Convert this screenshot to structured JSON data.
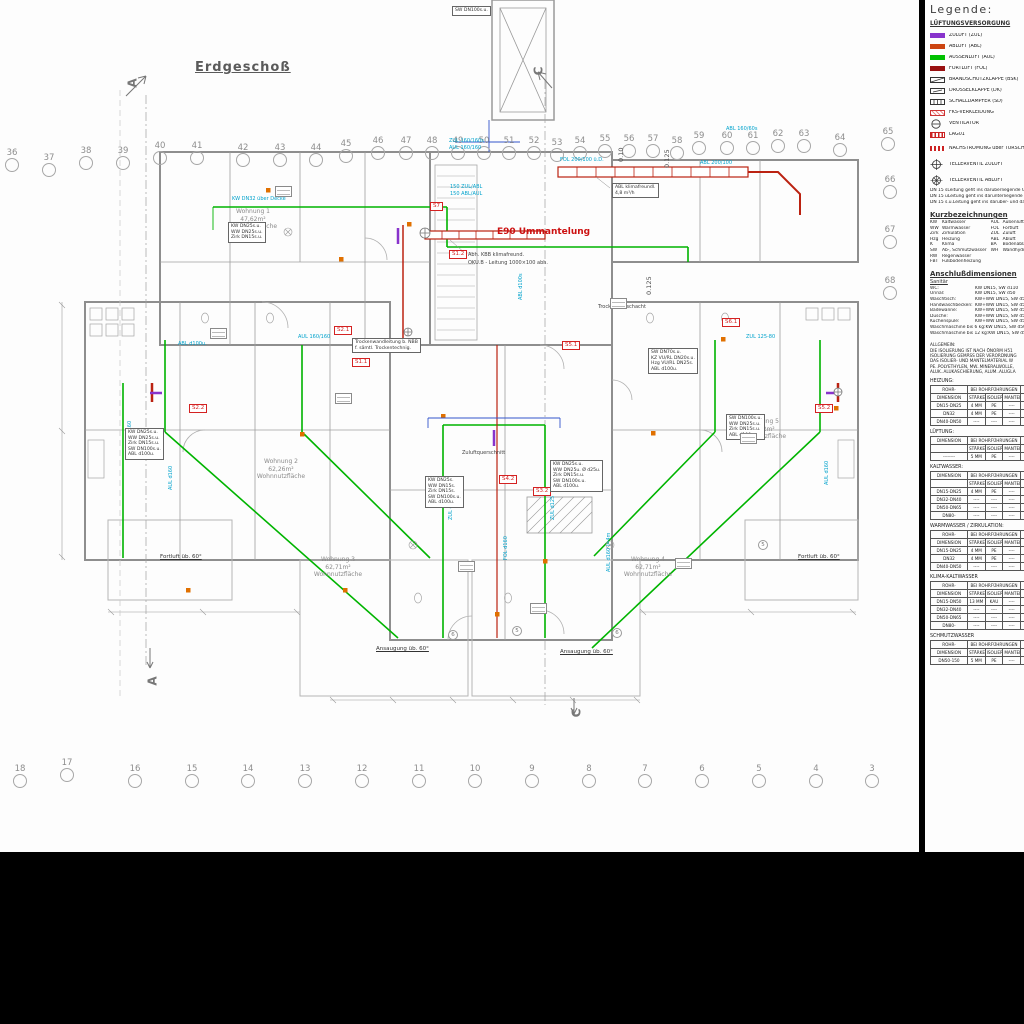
{
  "sheet": {
    "title": "Erdgeschoß"
  },
  "legend": {
    "heading": "Legende:",
    "vent_title": "LÜFTUNGSVERSORGUNG",
    "vent_items": [
      {
        "label": "ZULUFT  (ZUL)",
        "icon": "swatch",
        "color": "#8833cc"
      },
      {
        "label": "ABLUFT  (ABL)",
        "icon": "swatch",
        "color": "#cc4411"
      },
      {
        "label": "AUSSENLUFT  (AUL)",
        "icon": "swatch",
        "color": "#00c000"
      },
      {
        "label": "FORTLUFT  (FOL)",
        "icon": "swatch",
        "color": "#991111"
      },
      {
        "label": "BRANDSCHUTZKLAPPE  (BSK)",
        "icon": "bsk"
      },
      {
        "label": "DROSSELKLAPPE  (DK)",
        "icon": "dk"
      },
      {
        "label": "SCHALLDÄMPFER  (SD)",
        "icon": "sd"
      },
      {
        "label": "FKS-VERKLEIDUNG",
        "icon": "fks"
      },
      {
        "label": "VENTILATOR",
        "icon": "fan"
      },
      {
        "label": "LAG01",
        "icon": "lag"
      }
    ],
    "valve_items": [
      {
        "label": "NACHSTRÖMUNG über TÜRSCHLITZ",
        "icon": "doorflow"
      },
      {
        "label": "TELLERVENTIL ZULUFT",
        "icon": "valvez"
      },
      {
        "label": "TELLERVENTIL ABLUFT",
        "icon": "valvea"
      }
    ],
    "dn_notes": [
      [
        "DN 15 s",
        "Leitung geht ins darüberliegende Geschoß"
      ],
      [
        "DN 15 u",
        "Leitung geht ins darunterliegende Geschoß"
      ],
      [
        "DN 15 s.u.",
        "Leitung geht ins darüber- und darunterliegende Geschoß"
      ]
    ],
    "abbrev_title": "Kurzbezeichnungen",
    "abbrev_left": [
      [
        "KW",
        "Kaltwasser"
      ],
      [
        "WW",
        "Warmwasser"
      ],
      [
        "Zirk",
        "Zirkulation"
      ],
      [
        "Hzg",
        "Heizung"
      ],
      [
        "K",
        "Klima"
      ],
      [
        "SW",
        "Ab-, Schmutzwasser"
      ],
      [
        "RW",
        "Regenwasser"
      ],
      [
        "FBT",
        "Fußbodenheizung"
      ]
    ],
    "abbrev_right": [
      [
        "AUL",
        "Außenluft"
      ],
      [
        "FOL",
        "Fortluft"
      ],
      [
        "ZUL",
        "Zuluft"
      ],
      [
        "ABL",
        "Abluft"
      ],
      [
        "BA",
        "Bodenablauf"
      ],
      [
        "WH",
        "Wandhydrant"
      ]
    ],
    "anschluss_title": "Anschlußdimensionen",
    "anschluss_sub": "Sanitär",
    "anschluss_rows": [
      [
        "WC:",
        "KW DN15, SW d110"
      ],
      [
        "Urinal:",
        "KW DN15, SW d50"
      ],
      [
        "Waschtisch:",
        "KW+WW DN15, SW d50"
      ],
      [
        "Handwaschbecken:",
        "KW+WW DN15, SW d50"
      ],
      [
        "Badewanne:",
        "KW+WW DN15, SW d50"
      ],
      [
        "Dusche:",
        "KW+WW DN15, SW d50"
      ],
      [
        "Küchenspüle:",
        "KW+WW DN15, SW d50"
      ],
      [
        "Waschmaschine bis 6 kg:",
        "KW DN15, SW d50"
      ],
      [
        "Waschmaschine bis 12 kg:",
        "KW DN15, SW d50"
      ]
    ],
    "allgemein": [
      "ALLGEMEIN:",
      "DIE ISOLIERUNG IST NACH ÖNORM H51",
      "ISOLIERUNG GEMÄSS DER VERORDNUNG",
      "DAS ISOLIER- UND MANTELMATERIAL W",
      "PE..POLYETHYLEN, MW..MINERALWOLLE,",
      "ALUK..ALUKASCHIERUNG, ALUM..ALUGLA"
    ],
    "tables": [
      {
        "title": "HEIZUNG:",
        "dim": [
          "ROHR-",
          "DIMENSION"
        ],
        "group": "BEI ROHRFÜHRUNGEN",
        "subs": [
          "STÄRKE",
          "ISOLIER.",
          "MANTEL"
        ],
        "rows": [
          [
            "DN15-DN25",
            "4 MM",
            "PE",
            "----"
          ],
          [
            "DN32",
            "4 MM",
            "PE",
            "----"
          ],
          [
            "DN40-DN50",
            "----",
            "----",
            "----"
          ]
        ]
      },
      {
        "title": "LÜFTUNG:",
        "dim": [
          "DIMENSION",
          ""
        ],
        "group": "BEI ROHRFÜHRUNGEN",
        "subs": [
          "STÄRKE",
          "ISOLIER.",
          "MANTEL"
        ],
        "rows": [
          [
            "--------",
            "5 MM",
            "PE",
            "----"
          ]
        ]
      },
      {
        "title": "KALTWASSER:",
        "dim": [
          "DIMENSION",
          ""
        ],
        "group": "BEI ROHRFÜHRUNGEN",
        "subs": [
          "STÄRKE",
          "ISOLIER.",
          "MANTEL"
        ],
        "rows": [
          [
            "DN15-DN25",
            "4 MM",
            "PE",
            "----"
          ],
          [
            "DN32-DN40",
            "----",
            "----",
            "----"
          ],
          [
            "DN50-DN65",
            "----",
            "----",
            "----"
          ],
          [
            "DN80-",
            "----",
            "----",
            "----"
          ]
        ]
      },
      {
        "title": "WARMWASSER / ZIRKULATION:",
        "dim": [
          "ROHR-",
          "DIMENSION"
        ],
        "group": "BEI ROHRFÜHRUNGEN",
        "subs": [
          "STÄRKE",
          "ISOLIER.",
          "MANTEL"
        ],
        "rows": [
          [
            "DN15-DN25",
            "4 MM",
            "PE",
            "----"
          ],
          [
            "DN32",
            "4 MM",
            "PE",
            "----"
          ],
          [
            "DN40-DN50",
            "----",
            "----",
            "----"
          ]
        ]
      },
      {
        "title": "KLIMA-KALTWASSER",
        "dim": [
          "ROHR-",
          "DIMENSION"
        ],
        "group": "BEI ROHRFÜHRUNGEN",
        "subs": [
          "STÄRKE",
          "ISOLIER.",
          "MANTEL"
        ],
        "rows": [
          [
            "DN15-DN50",
            "13 MM",
            "KAU",
            "----"
          ],
          [
            "DN32-DN40",
            "----",
            "----",
            "----"
          ],
          [
            "DN50-DN65",
            "----",
            "----",
            "----"
          ],
          [
            "DN80-",
            "----",
            "----",
            "----"
          ]
        ]
      },
      {
        "title": "SCHMUTZWASSER",
        "dim": [
          "ROHR-",
          "DIMENSION"
        ],
        "group": "BEI ROHRFÜHRUNGEN",
        "subs": [
          "STÄRKE",
          "ISOLIER.",
          "MANTEL"
        ],
        "rows": [
          [
            "DN50-150",
            "5 MM",
            "PE",
            "----"
          ]
        ]
      }
    ]
  },
  "grid": {
    "top": [
      {
        "n": "36",
        "x": 12,
        "y": 165
      },
      {
        "n": "37",
        "x": 49,
        "y": 170
      },
      {
        "n": "38",
        "x": 86,
        "y": 163
      },
      {
        "n": "39",
        "x": 123,
        "y": 163
      },
      {
        "n": "40",
        "x": 160,
        "y": 158
      },
      {
        "n": "41",
        "x": 197,
        "y": 158
      },
      {
        "n": "42",
        "x": 243,
        "y": 160
      },
      {
        "n": "43",
        "x": 280,
        "y": 160
      },
      {
        "n": "44",
        "x": 316,
        "y": 160
      },
      {
        "n": "45",
        "x": 346,
        "y": 156
      },
      {
        "n": "46",
        "x": 378,
        "y": 153
      },
      {
        "n": "47",
        "x": 406,
        "y": 153
      },
      {
        "n": "48",
        "x": 432,
        "y": 153
      },
      {
        "n": "49",
        "x": 458,
        "y": 153
      },
      {
        "n": "50",
        "x": 484,
        "y": 153
      },
      {
        "n": "51",
        "x": 509,
        "y": 153
      },
      {
        "n": "52",
        "x": 534,
        "y": 153
      },
      {
        "n": "53",
        "x": 557,
        "y": 155
      },
      {
        "n": "54",
        "x": 580,
        "y": 153
      },
      {
        "n": "55",
        "x": 605,
        "y": 151
      },
      {
        "n": "56",
        "x": 629,
        "y": 151
      },
      {
        "n": "57",
        "x": 653,
        "y": 151
      },
      {
        "n": "58",
        "x": 677,
        "y": 153
      },
      {
        "n": "59",
        "x": 699,
        "y": 148
      },
      {
        "n": "60",
        "x": 727,
        "y": 148
      },
      {
        "n": "61",
        "x": 753,
        "y": 148
      },
      {
        "n": "62",
        "x": 778,
        "y": 146
      },
      {
        "n": "63",
        "x": 804,
        "y": 146
      },
      {
        "n": "64",
        "x": 840,
        "y": 150
      },
      {
        "n": "65",
        "x": 888,
        "y": 144
      }
    ],
    "right": [
      {
        "n": "66",
        "x": 890,
        "y": 192
      },
      {
        "n": "67",
        "x": 890,
        "y": 242
      },
      {
        "n": "68",
        "x": 890,
        "y": 293
      }
    ],
    "bottom": [
      {
        "n": "18",
        "x": 20,
        "y": 781
      },
      {
        "n": "17",
        "x": 67,
        "y": 775
      },
      {
        "n": "16",
        "x": 135,
        "y": 781
      },
      {
        "n": "15",
        "x": 192,
        "y": 781
      },
      {
        "n": "14",
        "x": 248,
        "y": 781
      },
      {
        "n": "13",
        "x": 305,
        "y": 781
      },
      {
        "n": "12",
        "x": 362,
        "y": 781
      },
      {
        "n": "11",
        "x": 419,
        "y": 781
      },
      {
        "n": "10",
        "x": 475,
        "y": 781
      },
      {
        "n": "9",
        "x": 532,
        "y": 781
      },
      {
        "n": "8",
        "x": 589,
        "y": 781
      },
      {
        "n": "7",
        "x": 645,
        "y": 781
      },
      {
        "n": "6",
        "x": 702,
        "y": 781
      },
      {
        "n": "5",
        "x": 759,
        "y": 781
      },
      {
        "n": "4",
        "x": 816,
        "y": 781
      },
      {
        "n": "3",
        "x": 872,
        "y": 781
      }
    ]
  },
  "sections": [
    {
      "label": "A",
      "x": 128,
      "y": 76
    },
    {
      "label": "A",
      "x": 148,
      "y": 674
    },
    {
      "label": "C",
      "x": 534,
      "y": 64
    },
    {
      "label": "C",
      "x": 572,
      "y": 706
    }
  ],
  "plan": {
    "texts": [
      {
        "t": "ZUL 160/160s",
        "x": 449,
        "y": 138,
        "c": "cyan"
      },
      {
        "t": "AUL 160/160",
        "x": 449,
        "y": 145,
        "c": "cyan"
      },
      {
        "t": "150 ZUL/ABL",
        "x": 450,
        "y": 184,
        "c": "cyan"
      },
      {
        "t": "150 ABL/AUL",
        "x": 450,
        "y": 191,
        "c": "cyan"
      },
      {
        "t": "FOL 200/100 ü.D.",
        "x": 560,
        "y": 157,
        "c": "cyan"
      },
      {
        "t": "ABL 200/100",
        "x": 700,
        "y": 160,
        "c": "cyan"
      },
      {
        "t": "ABL 160/60s",
        "x": 726,
        "y": 126,
        "c": "cyan"
      },
      {
        "t": "KW DN32 über Decke",
        "x": 232,
        "y": 196,
        "c": "cyan"
      },
      {
        "t": "AUL 160/160",
        "x": 298,
        "y": 334,
        "c": "cyan"
      },
      {
        "t": "ZUL 125-80",
        "x": 746,
        "y": 334,
        "c": "cyan"
      },
      {
        "t": "ABL d100u.",
        "x": 178,
        "y": 341,
        "c": "cyan"
      },
      {
        "t": "ABL d100s",
        "x": 518,
        "y": 300,
        "c": "cyan r90"
      },
      {
        "t": "AUL d160",
        "x": 127,
        "y": 445,
        "c": "cyan r90"
      },
      {
        "t": "ZUL d125",
        "x": 448,
        "y": 520,
        "c": "cyan r90"
      },
      {
        "t": "ZUL d125",
        "x": 550,
        "y": 520,
        "c": "cyan r90"
      },
      {
        "t": "FOL d160",
        "x": 503,
        "y": 560,
        "c": "cyan r90"
      },
      {
        "t": "AUL d160 l=4m",
        "x": 606,
        "y": 572,
        "c": "cyan r90"
      },
      {
        "t": "AUL d160",
        "x": 824,
        "y": 485,
        "c": "cyan r90"
      },
      {
        "t": "AUL d160",
        "x": 168,
        "y": 490,
        "c": "cyan r90"
      },
      {
        "t": "Abh. KBB klimafreund.",
        "x": 468,
        "y": 252,
        "c": "blk"
      },
      {
        "t": "OKU.B - Leitung 1000×100 abh.",
        "x": 468,
        "y": 260,
        "c": "blk"
      },
      {
        "t": "Trockenbauschacht",
        "x": 598,
        "y": 304,
        "c": "blk"
      },
      {
        "t": "Zuluftquerschnitt",
        "x": 462,
        "y": 450,
        "c": "blk"
      },
      {
        "t": "Fortluft üb. 60°",
        "x": 160,
        "y": 554,
        "c": "undl"
      },
      {
        "t": "Fortluft üb. 60°",
        "x": 798,
        "y": 554,
        "c": "undl"
      },
      {
        "t": "Ansaugung üb. 60°",
        "x": 376,
        "y": 646,
        "c": "undl"
      },
      {
        "t": "Ansaugung üb. 60°",
        "x": 560,
        "y": 649,
        "c": "undl"
      },
      {
        "t": "0.10",
        "x": 618,
        "y": 162,
        "c": "dim r90"
      },
      {
        "t": "0.125",
        "x": 664,
        "y": 168,
        "c": "dim r90"
      },
      {
        "t": "0.125",
        "x": 646,
        "y": 295,
        "c": "dim r90"
      },
      {
        "t": "E90 Ummantelung",
        "x": 497,
        "y": 229,
        "c": "e90"
      }
    ],
    "apartments": [
      {
        "lines": [
          "Wohnung 1",
          "47,62m²",
          "Wohnnutzfläche"
        ],
        "x": 253,
        "y": 208
      },
      {
        "lines": [
          "Wohnung 2",
          "62,26m²",
          "Wohnnutzfläche"
        ],
        "x": 281,
        "y": 458
      },
      {
        "lines": [
          "Wohnung 3",
          "62,71m²",
          "Wohnnutzfläche"
        ],
        "x": 338,
        "y": 556
      },
      {
        "lines": [
          "Wohnung 4",
          "62,71m²",
          "Wohnnutzfläche"
        ],
        "x": 648,
        "y": 556
      },
      {
        "lines": [
          "Wohnung 5",
          "47,62m²",
          "Wohnnutzfläche"
        ],
        "x": 762,
        "y": 418
      }
    ],
    "stags": [
      {
        "t": "S7",
        "x": 430,
        "y": 202
      },
      {
        "t": "S1.2",
        "x": 449,
        "y": 250
      },
      {
        "t": "S2.1",
        "x": 334,
        "y": 326
      },
      {
        "t": "S1.1",
        "x": 352,
        "y": 358
      },
      {
        "t": "S2.2",
        "x": 189,
        "y": 404
      },
      {
        "t": "S4.2",
        "x": 499,
        "y": 475
      },
      {
        "t": "S3.2",
        "x": 533,
        "y": 487
      },
      {
        "t": "S5.1",
        "x": 562,
        "y": 341
      },
      {
        "t": "S5.2",
        "x": 815,
        "y": 404
      },
      {
        "t": "S6.1",
        "x": 722,
        "y": 318
      }
    ],
    "specboxes": [
      {
        "x": 452,
        "y": 6,
        "lines": [
          "SW DN100s.u."
        ]
      },
      {
        "x": 612,
        "y": 183,
        "lines": [
          "ABL klimafreundl.",
          "4,8 m³/h"
        ]
      },
      {
        "x": 228,
        "y": 222,
        "lines": [
          "KW DN25s.u.",
          "WW DN25s.u.",
          "Zirk DN15s.u."
        ]
      },
      {
        "x": 352,
        "y": 338,
        "lines": [
          "Trockenwandleitung b. NBB",
          "f. sämtl. Trockentechnig."
        ]
      },
      {
        "x": 648,
        "y": 348,
        "lines": [
          "SW DN70s.u.",
          "KZ VU/RL DN20s.u.",
          "Hzg VU/RL DN25s.",
          "ABL d100u."
        ]
      },
      {
        "x": 125,
        "y": 428,
        "lines": [
          "KW DN25s.u.",
          "WW DN25s.u.",
          "Zirk DN15s.u.",
          "SW DN100s.u.",
          "ABL d100u."
        ]
      },
      {
        "x": 550,
        "y": 460,
        "lines": [
          "KW DN25s.u.",
          "WW DN25u. Ø d25u.",
          "Zirk DN15s.u.",
          "SW DN100s.u.",
          "ABL d100u."
        ]
      },
      {
        "x": 425,
        "y": 476,
        "lines": [
          "KW DN25s.",
          "WW DN15s.",
          "Zirk DN15s.",
          "SW DN100s.u.",
          "ABL d100u."
        ]
      },
      {
        "x": 726,
        "y": 414,
        "lines": [
          "SW DN100s.u.",
          "WW DN25s.u.",
          "Zirk DN15s.u.",
          "ABL d100u."
        ]
      }
    ],
    "circnums": [
      {
        "t": "6",
        "x": 448,
        "y": 630
      },
      {
        "t": "5",
        "x": 512,
        "y": 626
      },
      {
        "t": "6",
        "x": 612,
        "y": 628
      },
      {
        "t": "5",
        "x": 758,
        "y": 540
      }
    ],
    "microtags": [
      {
        "x": 275,
        "y": 186
      },
      {
        "x": 335,
        "y": 393
      },
      {
        "x": 458,
        "y": 561
      },
      {
        "x": 530,
        "y": 603
      },
      {
        "x": 610,
        "y": 298
      },
      {
        "x": 740,
        "y": 433
      },
      {
        "x": 210,
        "y": 328
      },
      {
        "x": 675,
        "y": 558
      }
    ]
  },
  "colors": {
    "aussenluft": "#00b400",
    "zuluft": "#8833cc",
    "abluft": "#cc4411",
    "fortluft": "#991111",
    "duct_label": "#00a2cc",
    "shaft_tag": "#d42222"
  }
}
